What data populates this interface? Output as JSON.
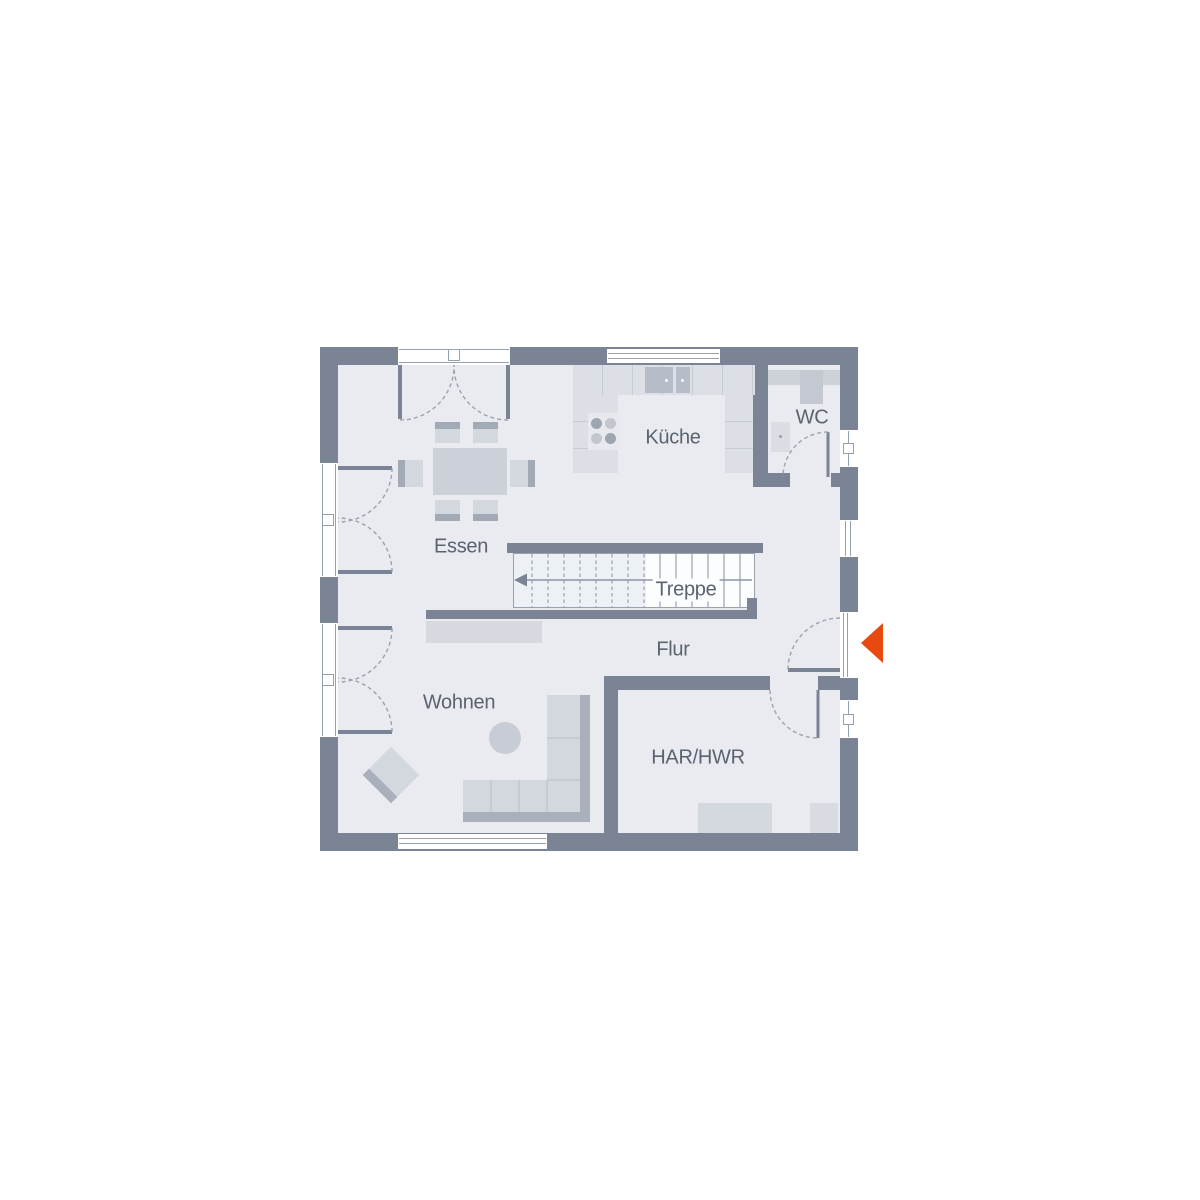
{
  "plan": {
    "type": "floor-plan",
    "rooms": [
      {
        "id": "kueche",
        "label": "Küche"
      },
      {
        "id": "wc",
        "label": "WC"
      },
      {
        "id": "essen",
        "label": "Essen"
      },
      {
        "id": "treppe",
        "label": "Treppe"
      },
      {
        "id": "flur",
        "label": "Flur"
      },
      {
        "id": "wohnen",
        "label": "Wohnen"
      },
      {
        "id": "har_hwr",
        "label": "HAR/HWR"
      }
    ],
    "icons": [
      {
        "name": "entrance-arrow-icon",
        "meaning": "main entrance direction marker"
      }
    ]
  },
  "colors": {
    "canvas": "#ffffff",
    "wall": "#7b8494",
    "floor": "#e9ebf0",
    "line": "#98a1ae",
    "label": "#5a6370",
    "accent": "#e8490f",
    "furniture": "#ccd0d8",
    "furniture-light": "#d3d7de",
    "furniture-dark": "#a2aab6",
    "counter": "#dcdfe5",
    "counter-line": "#c7cbd3",
    "sink": "#b7bdc8",
    "wc-fixture": "#c9cdd5"
  }
}
